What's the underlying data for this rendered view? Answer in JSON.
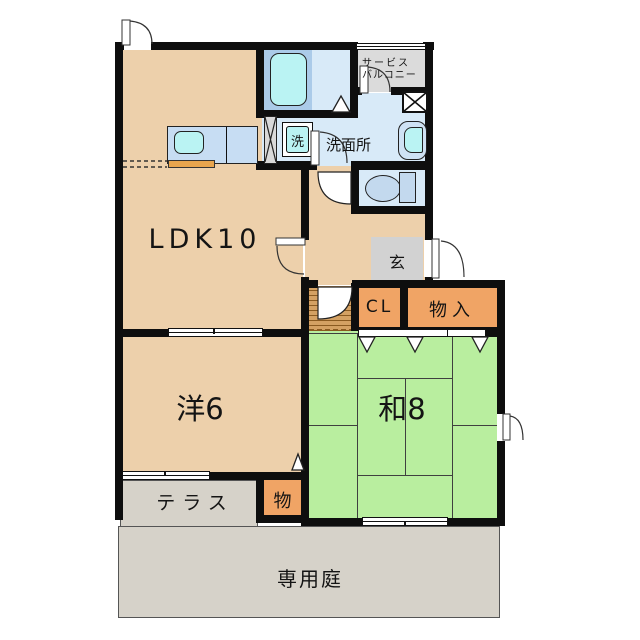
{
  "floorplan": {
    "rooms": {
      "ldk": {
        "label": "LDK10"
      },
      "western": {
        "label": "洋6"
      },
      "japanese": {
        "label": "和8"
      },
      "washroom": {
        "label": "洗面所"
      },
      "entrance": {
        "label": "玄"
      }
    },
    "storage": {
      "closet_cl": {
        "label": "CL"
      },
      "closet_big": {
        "label": "物入"
      },
      "closet_small": {
        "label": "物"
      }
    },
    "fixtures": {
      "washing_machine": {
        "label": "洗"
      }
    },
    "outdoor": {
      "terrace": {
        "label": "テラス"
      },
      "garden": {
        "label": "専用庭"
      },
      "service_balcony": {
        "label_line1": "サービス",
        "label_line2": "バルコニー"
      }
    }
  },
  "colors": {
    "wall": "#0e0e0e",
    "room_beige": "#edd0ab",
    "tatami_green": "#b9ee9f",
    "water_blue": "#d8eaf8",
    "tub_surround": "#abcbe9",
    "fixture_cyan": "#baf3f3",
    "counter_blue": "#c7ddf3",
    "closet_orange": "#f0a465",
    "wood_floor": "#d4a163",
    "outdoor_gray": "#d6d2c9",
    "genkan_gray": "#d2d2d2",
    "balcony_gray": "#dbdbdb"
  }
}
